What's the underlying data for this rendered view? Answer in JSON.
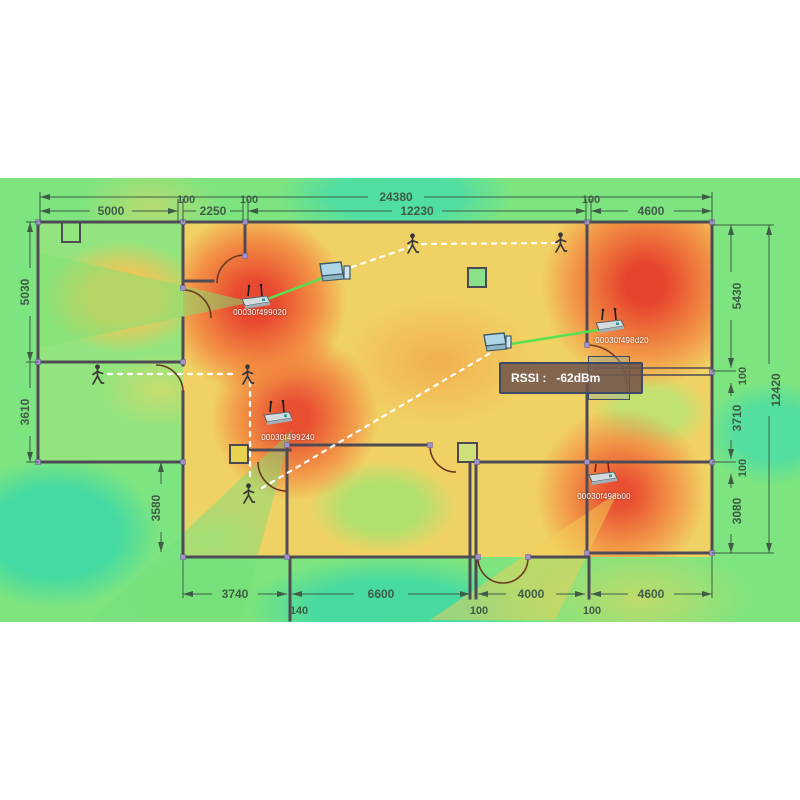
{
  "app": {
    "type": "wifi-coverage-floorplan-simulation"
  },
  "colors": {
    "heat_strong": "#e6422d",
    "heat_mid": "#f3822c",
    "heat_warm": "#f0d264",
    "heat_weak": "#7ee47f",
    "heat_cold": "#3ed9a6",
    "wall": "#4f4b55",
    "dimension_text": "#3f5d46",
    "link_active": "#57e052",
    "link_roaming": "#ffffff",
    "tooltip_border": "#3d4a66"
  },
  "dimensions": {
    "top_total": "24380",
    "top_row": [
      "5000",
      "100",
      "2250",
      "100",
      "12230",
      "100",
      "4600"
    ],
    "left": [
      "5030",
      "3610"
    ],
    "left_inner": "3580",
    "right": [
      "5430",
      "100",
      "3710",
      "100",
      "3080"
    ],
    "right_total": "12420",
    "bottom": [
      "3740",
      "140",
      "6600",
      "100",
      "4000",
      "100",
      "4600"
    ]
  },
  "access_points": [
    {
      "mac": "00030f499020"
    },
    {
      "mac": "00030f498d20"
    },
    {
      "mac": "00030f499240"
    },
    {
      "mac": "00030f498b00"
    }
  ],
  "tooltip": {
    "label": "RSSI :",
    "value": "-62dBm"
  }
}
